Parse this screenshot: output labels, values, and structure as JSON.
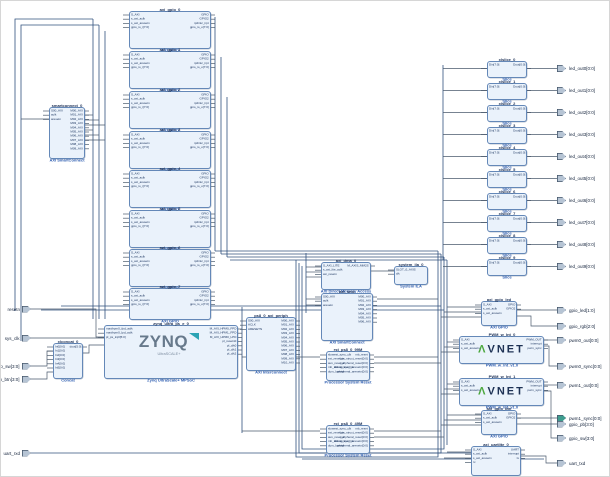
{
  "design": {
    "description": "Vivado IP Integrator block design",
    "background": "#ffffff"
  },
  "colors": {
    "block_fill": "#eaf2fb",
    "block_border": "#6488b8",
    "title": "#1b2f55",
    "type_label": "#2c5cb0",
    "net": "#4a5a6c",
    "bus": "#31517e",
    "port_fill": "#b6c4d4",
    "interface_port_fill": "#3f9d8f",
    "zynq_logo": "#67798b",
    "zynq_swoosh": "#2ba3b4",
    "avnet_navy": "#1d3154",
    "avnet_green": "#4ca83f"
  },
  "ports": {
    "inputs": [
      {
        "label": "resetn"
      },
      {
        "label": "sys_clk"
      },
      {
        "label": "dip_sw[3:0]"
      },
      {
        "label": "push_btn[3:0]"
      },
      {
        "label": "uart_rxd"
      }
    ],
    "outputs": [
      {
        "label": "led_out0[0:0]"
      },
      {
        "label": "led_out1[0:0]"
      },
      {
        "label": "led_out2[0:0]"
      },
      {
        "label": "led_out3[0:0]"
      },
      {
        "label": "led_out4[0:0]"
      },
      {
        "label": "led_out5[0:0]"
      },
      {
        "label": "led_out6[0:0]"
      },
      {
        "label": "led_out7[0:0]"
      },
      {
        "label": "led_out8[0:0]"
      },
      {
        "label": "led_out9[0:0]"
      },
      {
        "label": "gpio_led[1:0]"
      },
      {
        "label": "gpio_rgb[2:0]"
      },
      {
        "label": "pwm0_out[0:0]"
      },
      {
        "label": "pwm0_sync[0:0]"
      },
      {
        "label": "pwm1_out[0:0]"
      },
      {
        "label": "pwm1_sync[0:0]",
        "color": "#3f9d8f"
      },
      {
        "label": "gpio_pb[3:0]"
      },
      {
        "label": "gpio_sw[3:0]"
      },
      {
        "label": "uart_txd"
      }
    ]
  },
  "blocks": [
    {
      "id": "smartconnect_0",
      "title": "smartconnect_0",
      "label": "AXI SmartConnect",
      "left_pins": [
        "S00_AXI",
        "aclk",
        "aresetn"
      ],
      "right_pins": [
        "M00_AXI",
        "M01_AXI",
        "M02_AXI",
        "M03_AXI",
        "M04_AXI",
        "M05_AXI",
        "M06_AXI",
        "M07_AXI",
        "M08_AXI",
        "M09_AXI"
      ]
    },
    {
      "id": "axi_gpio_0",
      "title": "axi_gpio_0",
      "label": "AXI GPIO",
      "left_pins": [
        "S_AXI",
        "s_axi_aclk",
        "s_axi_aresetn",
        "gpio_io_i[7:0]"
      ],
      "right_pins": [
        "GPIO",
        "GPIO2",
        "ip2intc_irpt",
        "gpio_io_o[7:0]"
      ]
    },
    {
      "id": "axi_gpio_1",
      "title": "axi_gpio_1",
      "label": "AXI GPIO",
      "left_pins": [
        "S_AXI",
        "s_axi_aclk",
        "s_axi_aresetn",
        "gpio_io_i[7:0]"
      ],
      "right_pins": [
        "GPIO",
        "GPIO2",
        "ip2intc_irpt",
        "gpio_io_o[7:0]"
      ]
    },
    {
      "id": "axi_gpio_2",
      "title": "axi_gpio_2",
      "label": "AXI GPIO",
      "left_pins": [
        "S_AXI",
        "s_axi_aclk",
        "s_axi_aresetn",
        "gpio_io_i[7:0]"
      ],
      "right_pins": [
        "GPIO",
        "GPIO2",
        "ip2intc_irpt",
        "gpio_io_o[7:0]"
      ]
    },
    {
      "id": "axi_gpio_3",
      "title": "axi_gpio_3",
      "label": "AXI GPIO",
      "left_pins": [
        "S_AXI",
        "s_axi_aclk",
        "s_axi_aresetn",
        "gpio_io_i[7:0]"
      ],
      "right_pins": [
        "GPIO",
        "GPIO2",
        "ip2intc_irpt",
        "gpio_io_o[7:0]"
      ]
    },
    {
      "id": "axi_gpio_4",
      "title": "axi_gpio_4",
      "label": "AXI GPIO",
      "left_pins": [
        "S_AXI",
        "s_axi_aclk",
        "s_axi_aresetn",
        "gpio_io_i[7:0]"
      ],
      "right_pins": [
        "GPIO",
        "GPIO2",
        "ip2intc_irpt",
        "gpio_io_o[7:0]"
      ]
    },
    {
      "id": "axi_gpio_5",
      "title": "axi_gpio_5",
      "label": "AXI GPIO",
      "left_pins": [
        "S_AXI",
        "s_axi_aclk",
        "s_axi_aresetn",
        "gpio_io_i[7:0]"
      ],
      "right_pins": [
        "GPIO",
        "GPIO2",
        "ip2intc_irpt",
        "gpio_io_o[7:0]"
      ]
    },
    {
      "id": "axi_gpio_6",
      "title": "axi_gpio_6",
      "label": "AXI GPIO",
      "left_pins": [
        "S_AXI",
        "s_axi_aclk",
        "s_axi_aresetn",
        "gpio_io_i[7:0]"
      ],
      "right_pins": [
        "GPIO",
        "GPIO2",
        "ip2intc_irpt",
        "gpio_io_o[7:0]"
      ]
    },
    {
      "id": "axi_gpio_7",
      "title": "axi_gpio_7",
      "label": "AXI GPIO",
      "left_pins": [
        "S_AXI",
        "s_axi_aclk",
        "s_axi_aresetn",
        "gpio_io_i[7:0]"
      ],
      "right_pins": [
        "GPIO",
        "GPIO2",
        "ip2intc_irpt",
        "gpio_io_o[7:0]"
      ]
    },
    {
      "id": "zynq_ultra_ps_e_0",
      "title": "zynq_ultra_ps_e_0",
      "label": "Zynq UltraScale+ MPSoC",
      "logo": "zynq",
      "logo_text": "ZYNQ",
      "logo_sub": "UltraSCALE+",
      "left_pins": [
        "maxihpm0_fpd_aclk",
        "maxihpm0_lpd_aclk",
        "pl_ps_irq0[5:0]"
      ],
      "right_pins": [
        "M_AXI_HPM0_FPD",
        "M_AXI_HPM1_FPD",
        "M_AXI_HPM0_LPD",
        "pl_resetn0",
        "pl_clk0",
        "pl_clk1",
        "pl_clk2"
      ]
    },
    {
      "id": "xlconcat_0",
      "title": "xlconcat_0",
      "label": "Concat",
      "left_pins": [
        "In0[0:0]",
        "In1[0:0]",
        "In2[0:0]",
        "In3[0:0]",
        "In4[0:0]",
        "In5[0:0]"
      ],
      "right_pins": [
        "dout[5:0]"
      ]
    },
    {
      "id": "ps8_0_axi_periph",
      "title": "ps8_0_axi_periph",
      "label": "AXI Interconnect",
      "left_pins": [
        "S00_AXI",
        "ACLK",
        "ARESETN"
      ],
      "right_pins": [
        "M00_AXI",
        "M01_AXI",
        "M02_AXI",
        "M03_AXI",
        "M04_AXI",
        "M05_AXI",
        "M06_AXI",
        "M07_AXI",
        "M08_AXI",
        "M09_AXI",
        "M10_AXI"
      ]
    },
    {
      "id": "axi_dma_0",
      "title": "axi_dma_0",
      "label": "AXI Direct Memory Access",
      "left_pins": [
        "S_AXI_LITE",
        "s_axi_lite_aclk",
        "axi_resetn"
      ],
      "right_pins": [
        "M_AXIS_MM2S"
      ]
    },
    {
      "id": "system_ila_0",
      "title": "system_ila_0",
      "label": "System ILA",
      "left_pins": [
        "SLOT_0_AXIS",
        "clk"
      ],
      "right_pins": []
    },
    {
      "id": "axi_smc",
      "title": "axi_smc",
      "label": "AXI SmartConnect",
      "left_pins": [
        "S00_AXI",
        "aclk",
        "aresetn"
      ],
      "right_pins": [
        "M00_AXI",
        "M01_AXI",
        "M02_AXI",
        "M03_AXI",
        "M04_AXI",
        "M05_AXI",
        "M06_AXI"
      ]
    },
    {
      "id": "rst_ps8_0_99M",
      "title": "rst_ps8_0_99M",
      "label": "Processor System Reset",
      "left_pins": [
        "slowest_sync_clk",
        "ext_reset_in",
        "aux_reset_in",
        "mb_debug_sys_rst",
        "dcm_locked"
      ],
      "right_pins": [
        "mb_reset",
        "bus_struct_reset[0:0]",
        "peripheral_reset[0:0]",
        "interconnect_aresetn[0:0]",
        "peripheral_aresetn[0:0]"
      ]
    },
    {
      "id": "rst_ps8_0_49M",
      "title": "rst_ps8_0_49M",
      "label": "Processor System Reset",
      "left_pins": [
        "slowest_sync_clk",
        "ext_reset_in",
        "aux_reset_in",
        "mb_debug_sys_rst",
        "dcm_locked"
      ],
      "right_pins": [
        "mb_reset",
        "bus_struct_reset[0:0]",
        "peripheral_reset[0:0]",
        "interconnect_aresetn[0:0]",
        "peripheral_aresetn[0:0]"
      ]
    },
    {
      "id": "xlslice_0",
      "title": "xlslice_0",
      "label": "Slice",
      "left_pins": [
        "Din[7:0]"
      ],
      "right_pins": [
        "Dout[0:0]"
      ]
    },
    {
      "id": "xlslice_1",
      "title": "xlslice_1",
      "label": "Slice",
      "left_pins": [
        "Din[7:0]"
      ],
      "right_pins": [
        "Dout[0:0]"
      ]
    },
    {
      "id": "xlslice_2",
      "title": "xlslice_2",
      "label": "Slice",
      "left_pins": [
        "Din[7:0]"
      ],
      "right_pins": [
        "Dout[0:0]"
      ]
    },
    {
      "id": "xlslice_3",
      "title": "xlslice_3",
      "label": "Slice",
      "left_pins": [
        "Din[7:0]"
      ],
      "right_pins": [
        "Dout[0:0]"
      ]
    },
    {
      "id": "xlslice_4",
      "title": "xlslice_4",
      "label": "Slice",
      "left_pins": [
        "Din[7:0]"
      ],
      "right_pins": [
        "Dout[0:0]"
      ]
    },
    {
      "id": "xlslice_5",
      "title": "xlslice_5",
      "label": "Slice",
      "left_pins": [
        "Din[7:0]"
      ],
      "right_pins": [
        "Dout[0:0]"
      ]
    },
    {
      "id": "xlslice_6",
      "title": "xlslice_6",
      "label": "Slice",
      "left_pins": [
        "Din[7:0]"
      ],
      "right_pins": [
        "Dout[0:0]"
      ]
    },
    {
      "id": "xlslice_7",
      "title": "xlslice_7",
      "label": "Slice",
      "left_pins": [
        "Din[7:0]"
      ],
      "right_pins": [
        "Dout[0:0]"
      ]
    },
    {
      "id": "xlslice_8",
      "title": "xlslice_8",
      "label": "Slice",
      "left_pins": [
        "Din[7:0]"
      ],
      "right_pins": [
        "Dout[0:0]"
      ]
    },
    {
      "id": "xlslice_9",
      "title": "xlslice_9",
      "label": "Slice",
      "left_pins": [
        "Din[7:0]"
      ],
      "right_pins": [
        "Dout[0:0]"
      ]
    },
    {
      "id": "axi_gpio_led",
      "title": "axi_gpio_led",
      "label": "AXI GPIO",
      "left_pins": [
        "S_AXI",
        "s_axi_aclk",
        "s_axi_aresetn"
      ],
      "right_pins": [
        "GPIO",
        "GPIO2"
      ]
    },
    {
      "id": "PWM_w_Int_0",
      "title": "PWM_w_Int_0",
      "label": "PWM_w_Int_v1.0",
      "logo": "avnet",
      "logo_mark": "Λ",
      "logo_text": "VNET",
      "left_pins": [
        "S_AXI",
        "s_axi_aclk",
        "s_axi_aresetn"
      ],
      "right_pins": [
        "PWM_OUT",
        "interrupt",
        "pwm_sync"
      ]
    },
    {
      "id": "PWM_w_Int_1",
      "title": "PWM_w_Int_1",
      "label": "PWM_w_Int_v1.0",
      "logo": "avnet",
      "logo_mark": "Λ",
      "logo_text": "VNET",
      "left_pins": [
        "S_AXI",
        "s_axi_aclk",
        "s_axi_aresetn"
      ],
      "right_pins": [
        "PWM_OUT",
        "interrupt",
        "pwm_sync"
      ]
    },
    {
      "id": "axi_gpio_btn",
      "title": "axi_gpio_btn",
      "label": "AXI GPIO",
      "left_pins": [
        "S_AXI",
        "s_axi_aclk",
        "s_axi_aresetn"
      ],
      "right_pins": [
        "GPIO",
        "GPIO2"
      ]
    },
    {
      "id": "axi_uartlite_0",
      "title": "axi_uartlite_0",
      "label": "AXI Uartlite",
      "left_pins": [
        "S_AXI",
        "s_axi_aclk",
        "s_axi_aresetn",
        "rx"
      ],
      "right_pins": [
        "UART",
        "interrupt",
        "tx"
      ]
    }
  ]
}
